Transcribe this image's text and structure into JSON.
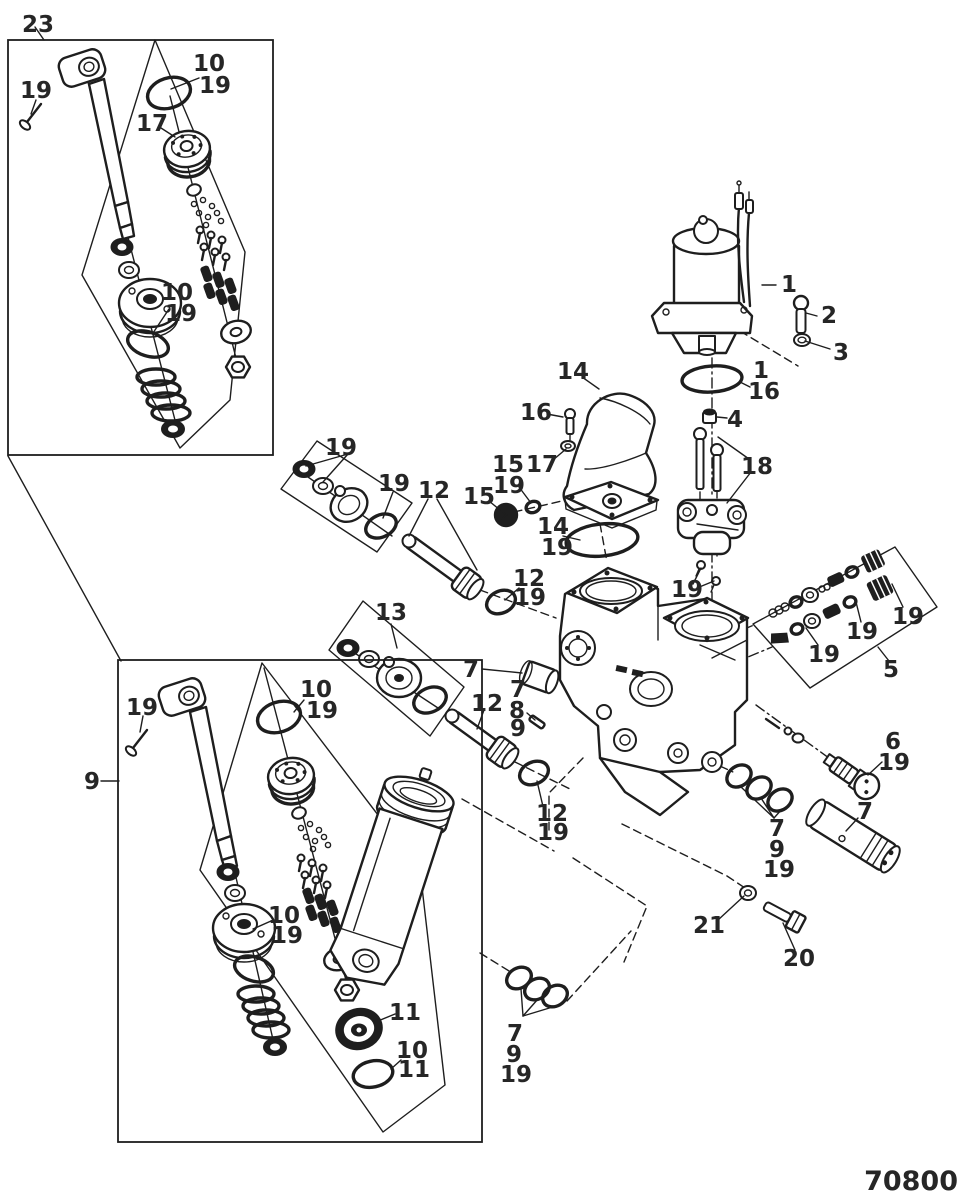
{
  "drawing": {
    "number": "70800"
  },
  "colors": {
    "line": "#1e1e1e",
    "label": "#262626",
    "background": "#ffffff"
  },
  "callouts": [
    {
      "label": "23"
    },
    {
      "label": "19"
    },
    {
      "label": "10"
    },
    {
      "label": "19"
    },
    {
      "label": "17"
    },
    {
      "label": "10"
    },
    {
      "label": "19"
    },
    {
      "label": "1"
    },
    {
      "label": "2"
    },
    {
      "label": "3"
    },
    {
      "label": "1"
    },
    {
      "label": "16"
    },
    {
      "label": "4"
    },
    {
      "label": "14"
    },
    {
      "label": "16"
    },
    {
      "label": "17"
    },
    {
      "label": "15"
    },
    {
      "label": "19"
    },
    {
      "label": "15"
    },
    {
      "label": "14"
    },
    {
      "label": "19"
    },
    {
      "label": "18"
    },
    {
      "label": "19"
    },
    {
      "label": "19"
    },
    {
      "label": "19"
    },
    {
      "label": "19"
    },
    {
      "label": "5"
    },
    {
      "label": "6"
    },
    {
      "label": "19"
    },
    {
      "label": "7"
    },
    {
      "label": "7"
    },
    {
      "label": "9"
    },
    {
      "label": "19"
    },
    {
      "label": "21"
    },
    {
      "label": "20"
    },
    {
      "label": "19"
    },
    {
      "label": "19"
    },
    {
      "label": "12"
    },
    {
      "label": "12"
    },
    {
      "label": "19"
    },
    {
      "label": "13"
    },
    {
      "label": "7"
    },
    {
      "label": "7"
    },
    {
      "label": "8"
    },
    {
      "label": "9"
    },
    {
      "label": "12"
    },
    {
      "label": "12"
    },
    {
      "label": "19"
    },
    {
      "label": "9"
    },
    {
      "label": "19"
    },
    {
      "label": "10"
    },
    {
      "label": "19"
    },
    {
      "label": "10"
    },
    {
      "label": "19"
    },
    {
      "label": "11"
    },
    {
      "label": "10"
    },
    {
      "label": "11"
    },
    {
      "label": "7"
    },
    {
      "label": "9"
    },
    {
      "label": "19"
    }
  ]
}
